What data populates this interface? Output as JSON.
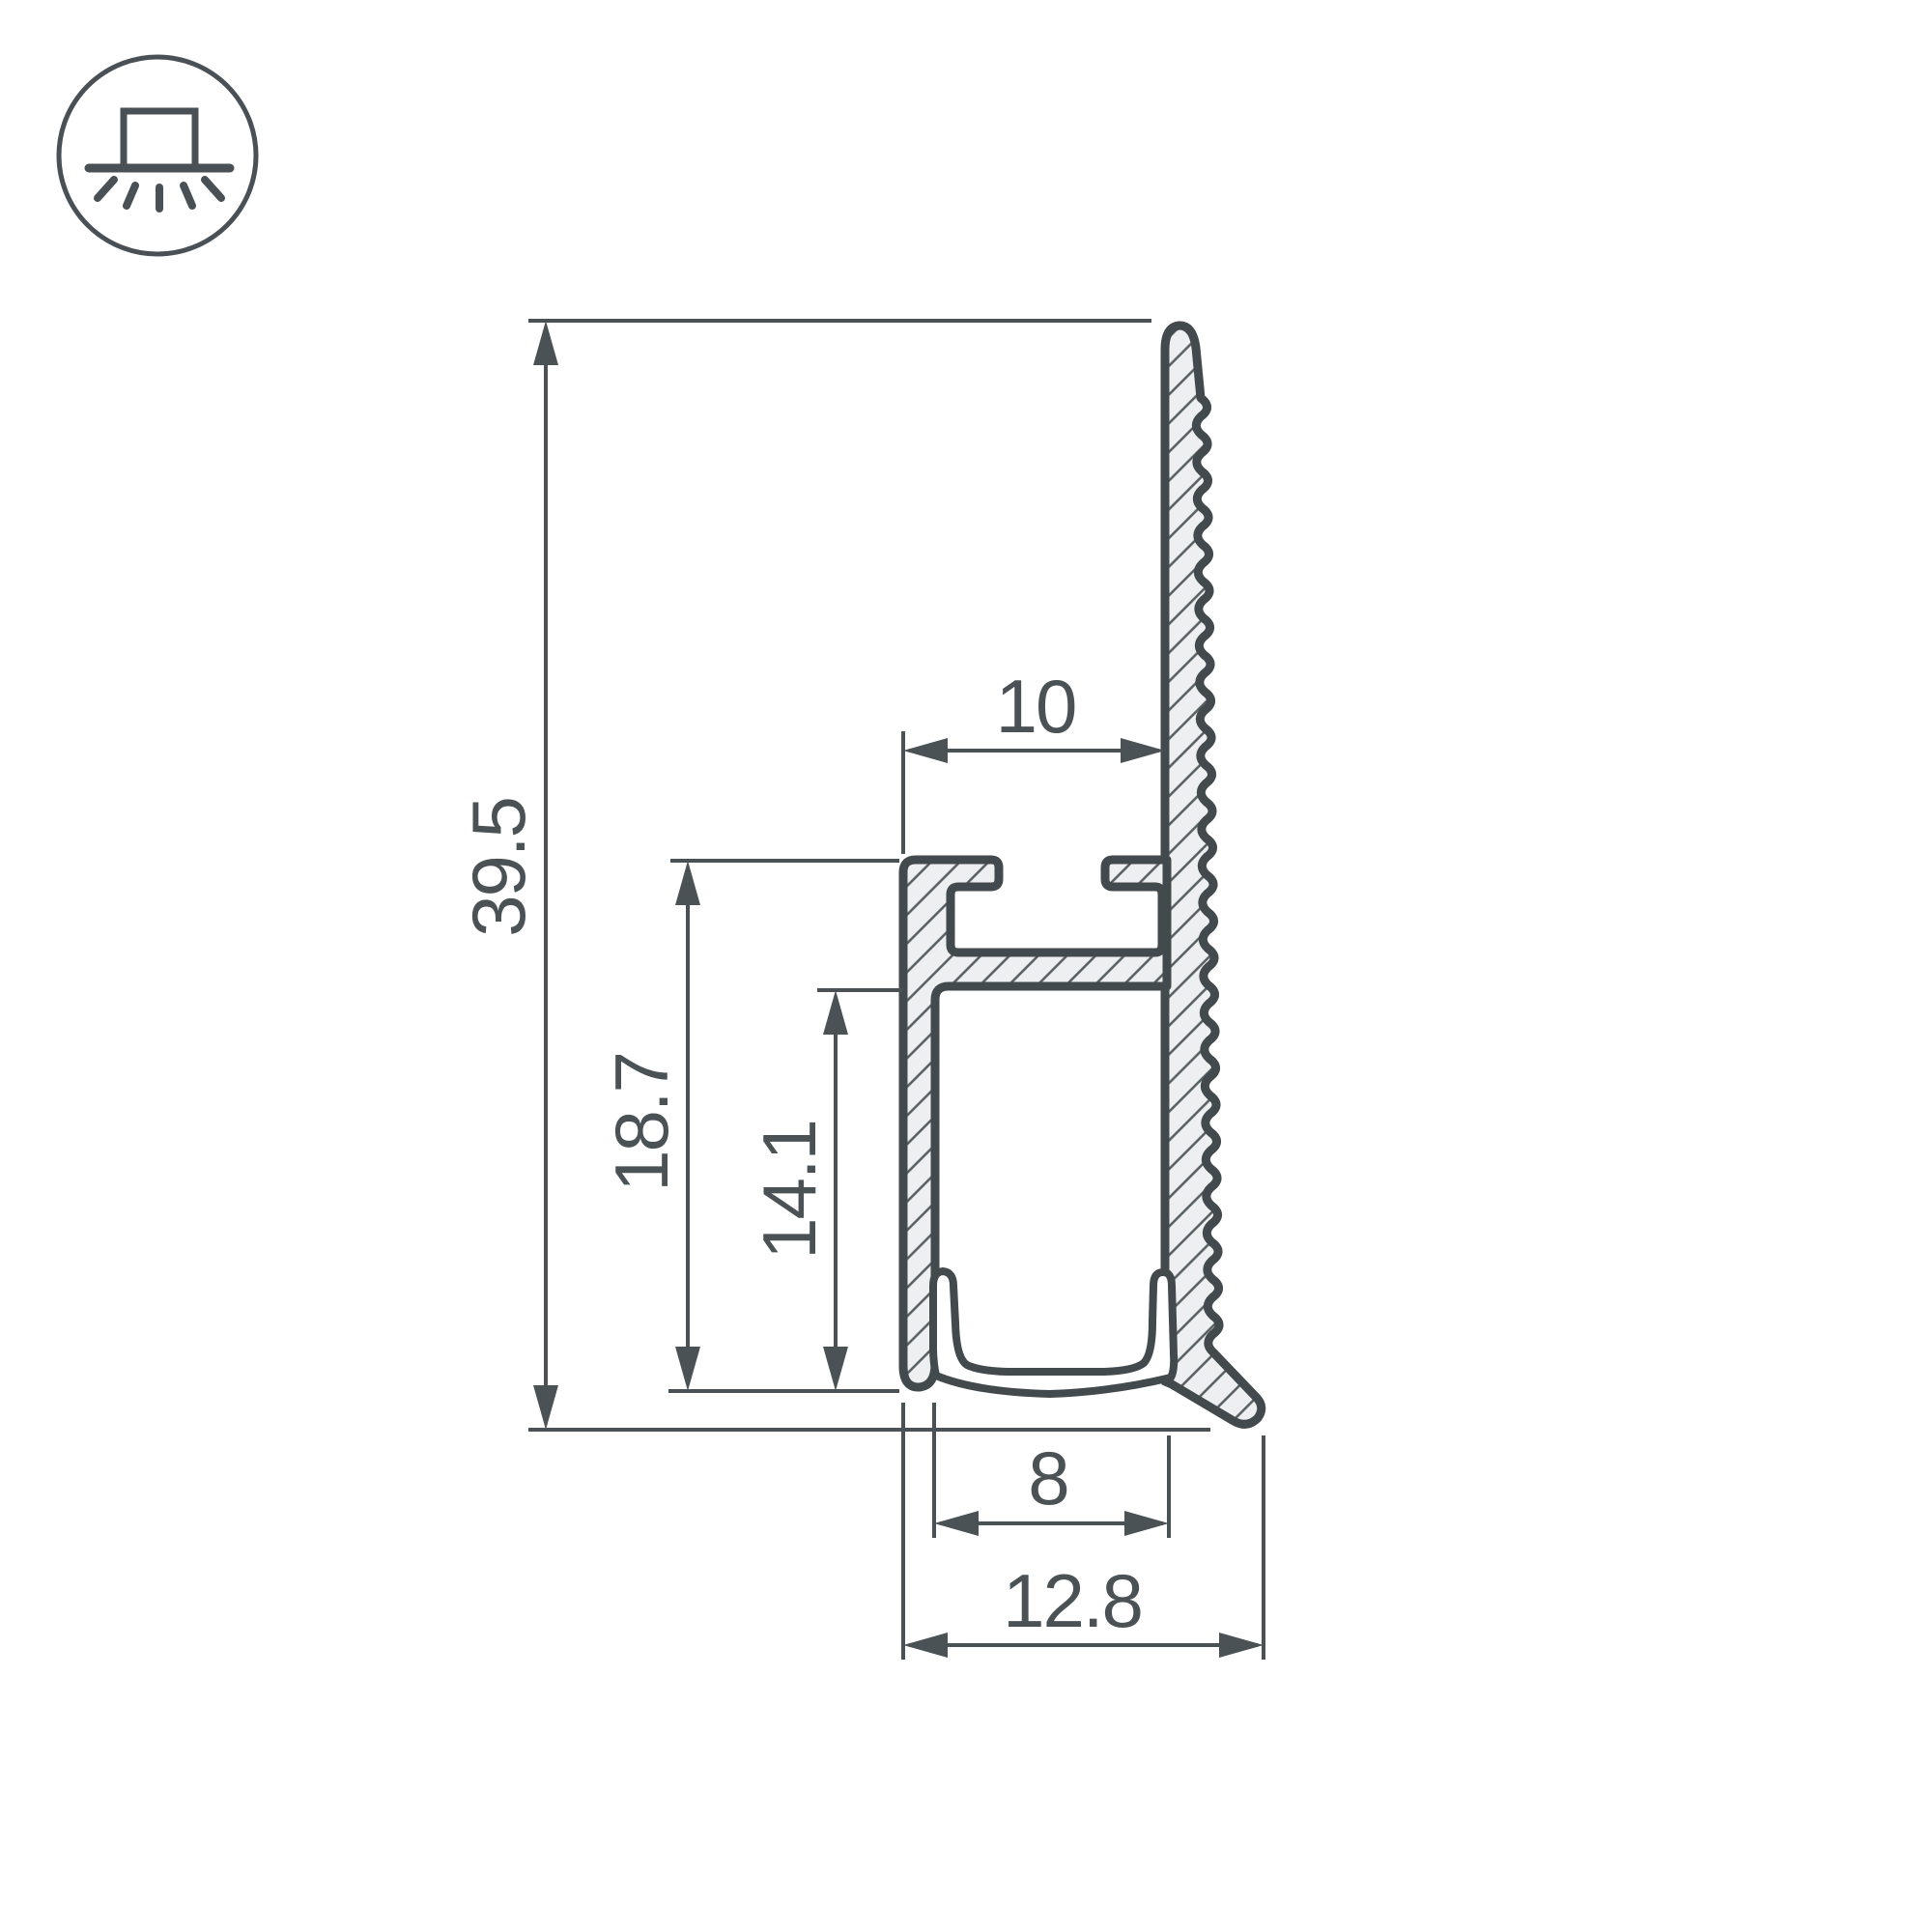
{
  "icon": {
    "name": "surface-mount-downlight-icon"
  },
  "dims": {
    "overall_height": "39.5",
    "wall_height": "18.7",
    "inner_height": "14.1",
    "top_width": "10",
    "inner_width": "8",
    "overall_width": "12.8"
  },
  "colors": {
    "line": "#434a4d",
    "dim": "#4b5256",
    "hatch_fill": "#edeff0",
    "hatch_line": "#565d61",
    "background": "#ffffff",
    "icon": "#4a5156"
  }
}
